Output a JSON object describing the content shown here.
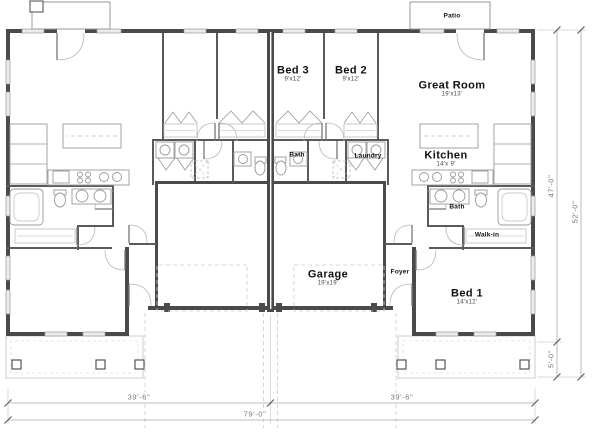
{
  "plan": {
    "patio": {
      "label": "Patio"
    },
    "rooms": {
      "bed3": {
        "label": "Bed 3",
        "dims": "9'x12'"
      },
      "bed2": {
        "label": "Bed 2",
        "dims": "9'x12'"
      },
      "great_room": {
        "label": "Great Room",
        "dims": "19'x13'"
      },
      "kitchen": {
        "label": "Kitchen",
        "dims": "14'x 9'"
      },
      "bath_hall": {
        "label": "Bath"
      },
      "laundry": {
        "label": "Laundry"
      },
      "bath_master": {
        "label": "Bath"
      },
      "walk_in": {
        "label": "Walk-in"
      },
      "foyer": {
        "label": "Foyer"
      },
      "garage": {
        "label": "Garage",
        "dims": "19'x19'"
      },
      "bed1": {
        "label": "Bed 1",
        "dims": "14'x12'"
      }
    },
    "dimensions": {
      "bottom_left": "39'-6\"",
      "bottom_right": "39'-6\"",
      "bottom_total": "79'-0\"",
      "right_upper": "47'-0\"",
      "right_lower": "5'-0\"",
      "right_total": "52'-0\""
    },
    "colors": {
      "wall": "#4a4a4a",
      "fixture": "#999999",
      "dimension": "#777777"
    }
  }
}
